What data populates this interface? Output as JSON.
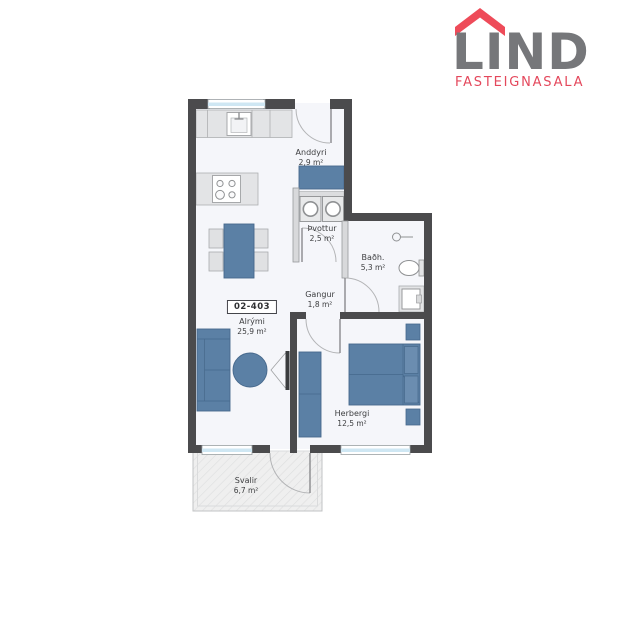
{
  "logo": {
    "name": "LIND",
    "tagline": "FASTEIGNASALA",
    "colors": {
      "roof": "#ee4b59",
      "name_text": "#76777a",
      "tagline_text": "#e4485c"
    }
  },
  "floorplan": {
    "unit_number": "02-403",
    "rooms": [
      {
        "key": "anddyri",
        "label": "Anddyri",
        "area": "2,9 m²"
      },
      {
        "key": "thvottur",
        "label": "Þvottur",
        "area": "2,5 m²"
      },
      {
        "key": "badherbergi",
        "label": "Baðh.",
        "area": "5,3 m²"
      },
      {
        "key": "gangur",
        "label": "Gangur",
        "area": "1,8 m²"
      },
      {
        "key": "alrymi",
        "label": "Alrými",
        "area": "25,9 m²"
      },
      {
        "key": "herbergi",
        "label": "Herbergi",
        "area": "12,5 m²"
      },
      {
        "key": "svalir",
        "label": "Svalir",
        "area": "6,7 m²"
      }
    ],
    "furniture_icons": [
      "kitchen-counter",
      "kitchen-sink",
      "cooktop",
      "dining-table",
      "chair",
      "sofa",
      "round-table",
      "tv",
      "laundry-cabinet",
      "washing-machine",
      "shower-head",
      "toilet",
      "vanity-sink",
      "wardrobe",
      "double-bed",
      "nightstand"
    ],
    "colors": {
      "exterior_wall": "#4b4b4d",
      "interior_wall": "#d8d9db",
      "floor": "#f5f6fa",
      "furniture_blue": "#5b80a5",
      "furniture_gray": "#e3e4e6",
      "window_glass": "#cfe7f3",
      "balcony_deck": "#efefef"
    }
  }
}
